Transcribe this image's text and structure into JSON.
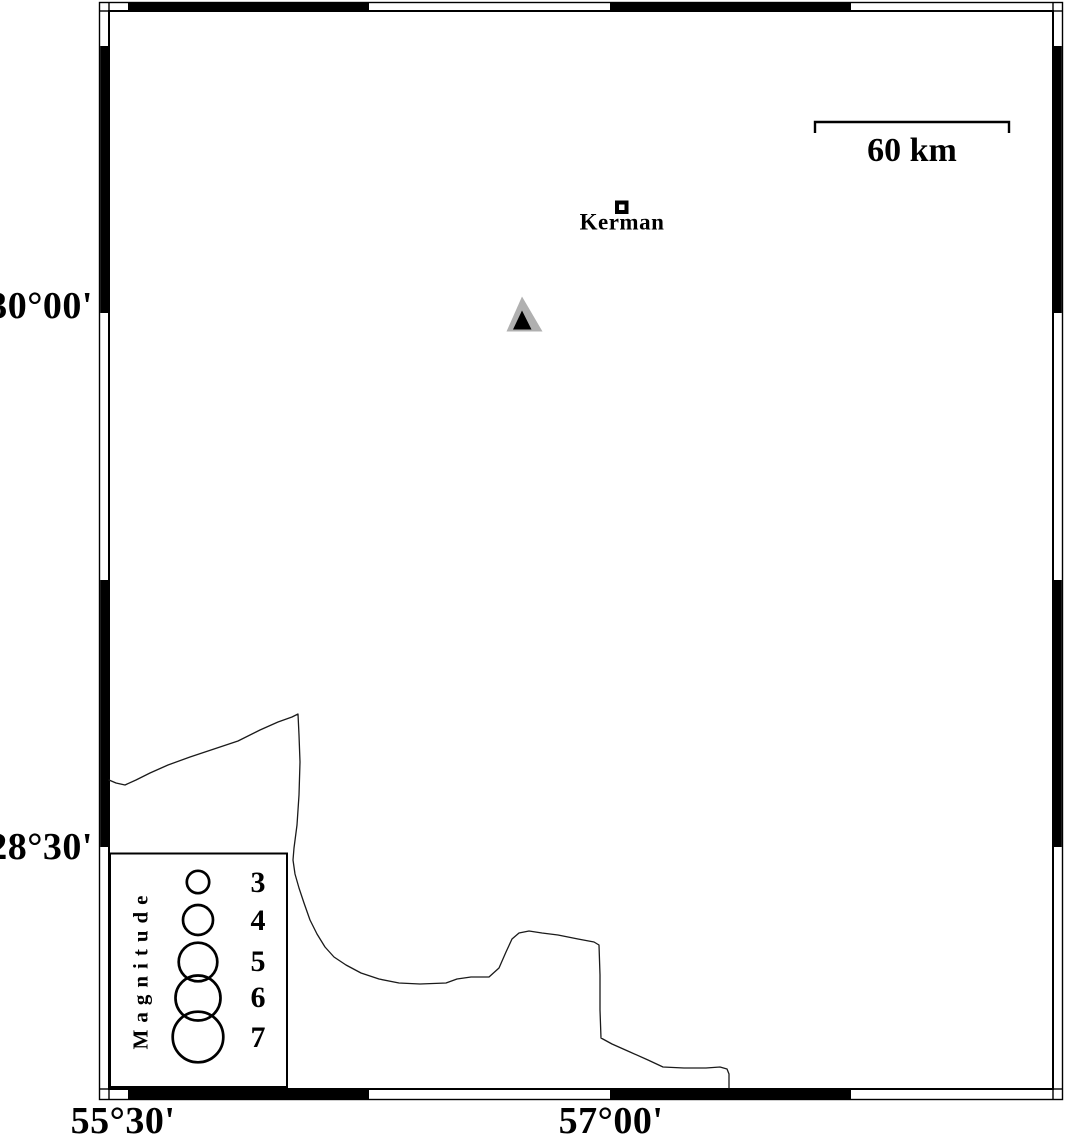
{
  "axes": {
    "left": [
      {
        "label": "30°00'"
      },
      {
        "label": "28°30'"
      }
    ],
    "bottom": [
      {
        "label": "55°30'"
      },
      {
        "label": "57°00'"
      }
    ]
  },
  "scale_bar": {
    "label": "60 km"
  },
  "city_marker": {
    "label": "Kerman",
    "x": 622,
    "y": 207
  },
  "station_marker": {
    "type": "triangle-station",
    "x": 522,
    "y": 315
  },
  "legend": {
    "title": "Magnitude",
    "entries": [
      {
        "label": "3",
        "cx": 198,
        "cy": 882,
        "r": 11.2
      },
      {
        "label": "4",
        "cx": 198,
        "cy": 920,
        "r": 15.0
      },
      {
        "label": "5",
        "cx": 198,
        "cy": 962,
        "r": 19.3
      },
      {
        "label": "6",
        "cx": 198,
        "cy": 998,
        "r": 22.5
      },
      {
        "label": "7",
        "cx": 198,
        "cy": 1037,
        "r": 25.3
      }
    ]
  },
  "coastline_points": [
    [
      109,
      780
    ],
    [
      116,
      783
    ],
    [
      125,
      785
    ],
    [
      136,
      780
    ],
    [
      150,
      773
    ],
    [
      168,
      765
    ],
    [
      190,
      757
    ],
    [
      214,
      749
    ],
    [
      238,
      741
    ],
    [
      260,
      730
    ],
    [
      278,
      722
    ],
    [
      292,
      717
    ],
    [
      298,
      714
    ],
    [
      299,
      735
    ],
    [
      300,
      762
    ],
    [
      299,
      795
    ],
    [
      297,
      825
    ],
    [
      294,
      848
    ],
    [
      293,
      860
    ],
    [
      295,
      874
    ],
    [
      299,
      888
    ],
    [
      304,
      903
    ],
    [
      310,
      920
    ],
    [
      317,
      934
    ],
    [
      325,
      947
    ],
    [
      334,
      957
    ],
    [
      346,
      965
    ],
    [
      361,
      973
    ],
    [
      379,
      979
    ],
    [
      399,
      983
    ],
    [
      420,
      984
    ],
    [
      446,
      983
    ],
    [
      457,
      979
    ],
    [
      471,
      977
    ],
    [
      489,
      977
    ],
    [
      499,
      968
    ],
    [
      506,
      952
    ],
    [
      512,
      939
    ],
    [
      519,
      933
    ],
    [
      529,
      931
    ],
    [
      542,
      933
    ],
    [
      558,
      935
    ],
    [
      578,
      939
    ],
    [
      594,
      942
    ],
    [
      599,
      945
    ],
    [
      600,
      975
    ],
    [
      600,
      1010
    ],
    [
      601,
      1038
    ],
    [
      612,
      1044
    ],
    [
      630,
      1052
    ],
    [
      648,
      1060
    ],
    [
      663,
      1067
    ],
    [
      684,
      1068
    ],
    [
      706,
      1068
    ],
    [
      720,
      1067
    ],
    [
      727,
      1069
    ],
    [
      729,
      1074
    ],
    [
      729,
      1088
    ]
  ],
  "colors": {
    "ink": "#000000",
    "background": "#ffffff",
    "station_fill": "#b0b0b0"
  }
}
